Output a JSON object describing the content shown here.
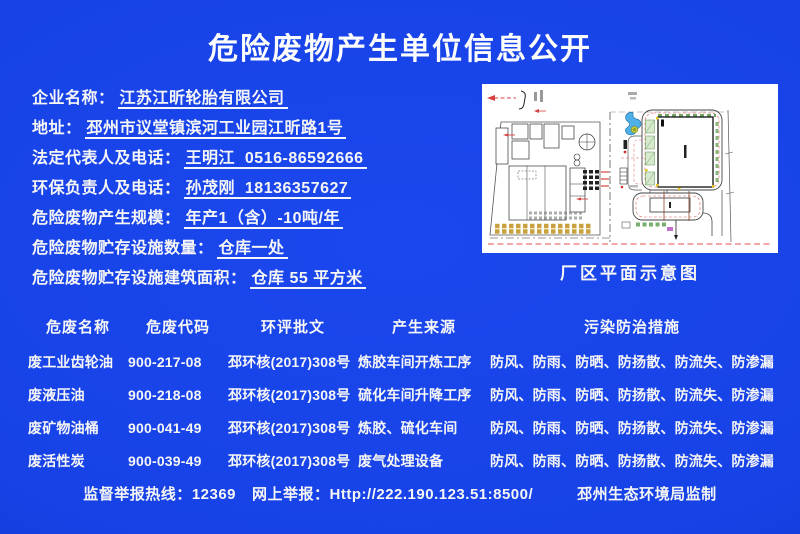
{
  "title": "危险废物产生单位信息公开",
  "info_fields": [
    {
      "label": "企业名称：",
      "value": "江苏江昕轮胎有限公司"
    },
    {
      "label": "地址：",
      "value": "邳州市议堂镇滨河工业园江昕路1号"
    },
    {
      "label": "法定代表人及电话：",
      "value": "王明江  0516-86592666"
    },
    {
      "label": "环保负责人及电话：",
      "value": "孙茂刚  18136357627"
    },
    {
      "label": "危险废物产生规模：",
      "value": "年产1（含）-10吨/年"
    },
    {
      "label": "危险废物贮存设施数量：",
      "value": "仓库一处"
    },
    {
      "label": "危险废物贮存设施建筑面积：",
      "value": "仓库 55 平方米"
    }
  ],
  "plan": {
    "caption": "厂区平面示意图"
  },
  "table": {
    "headers": [
      "危废名称",
      "危废代码",
      "环评批文",
      "产生来源",
      "污染防治措施"
    ],
    "rows": [
      [
        "废工业齿轮油",
        "900-217-08",
        "邳环核(2017)308号",
        "炼胶车间开炼工序",
        "防风、防雨、防晒、防扬散、防流失、防渗漏"
      ],
      [
        "废液压油",
        "900-218-08",
        "邳环核(2017)308号",
        "硫化车间升降工序",
        "防风、防雨、防晒、防扬散、防流失、防渗漏"
      ],
      [
        "废矿物油桶",
        "900-041-49",
        "邳环核(2017)308号",
        "炼胶、硫化车间",
        "防风、防雨、防晒、防扬散、防流失、防渗漏"
      ],
      [
        "废活性炭",
        "900-039-49",
        "邳环核(2017)308号",
        "废气处理设备",
        "防风、防雨、防晒、防扬散、防流失、防渗漏"
      ]
    ]
  },
  "footer": {
    "hotline_label": "监督举报热线：",
    "hotline_number": "12369",
    "web_label": "网上举报：",
    "web_url": "Http://222.190.123.51:8500/",
    "issuer": "邳州生态环境局监制"
  },
  "colors": {
    "background": "#1642e6",
    "text": "#f6f6f6"
  }
}
